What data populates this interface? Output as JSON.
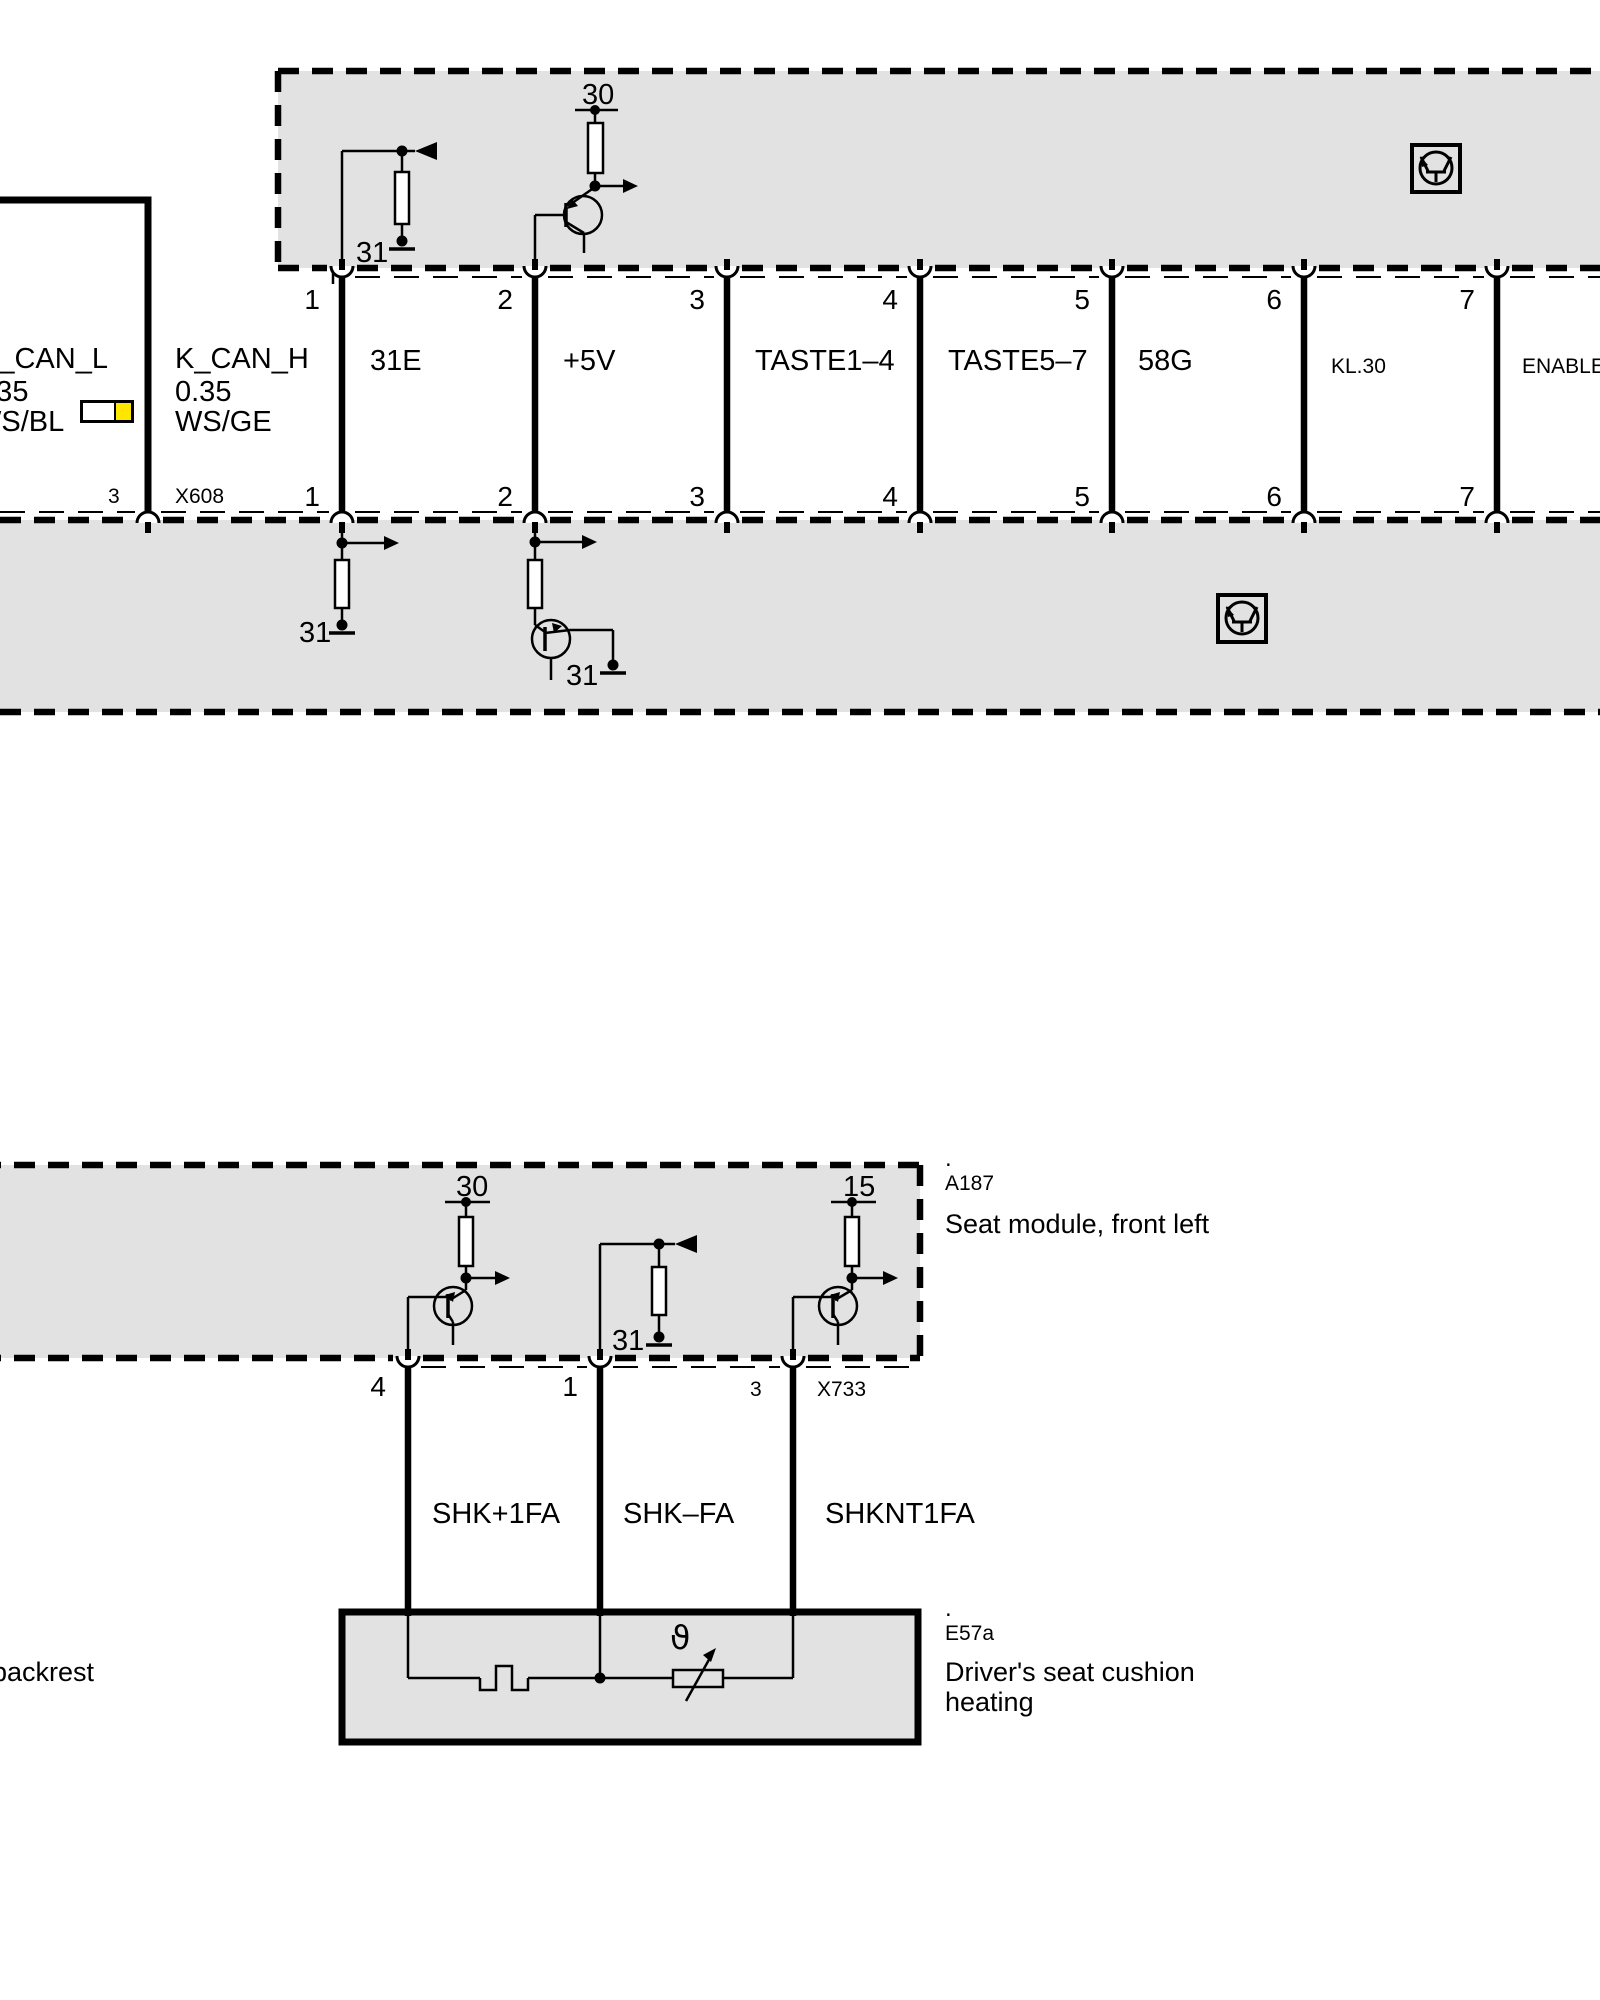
{
  "left_harness": {
    "can_l": {
      "name": "K_CAN_L",
      "gauge": "0.35",
      "color": "WS/BL"
    },
    "can_h": {
      "name": "K_CAN_H",
      "gauge": "0.35",
      "color": "WS/GE"
    },
    "pin": "3",
    "connector": "X608"
  },
  "top_module": {
    "supply_label": "30",
    "ground_label": "31",
    "pins_top": [
      "1",
      "2",
      "3",
      "4",
      "5",
      "6",
      "7"
    ],
    "pins_bottom": [
      "1",
      "2",
      "3",
      "4",
      "5",
      "6",
      "7"
    ],
    "wire_labels": [
      "31E",
      "+5V",
      "TASTE1–4",
      "TASTE5–7",
      "58G",
      "KL.30",
      "ENABLE"
    ]
  },
  "lower_band": {
    "ground_label_1": "31",
    "ground_label_2": "31"
  },
  "seat_module": {
    "dot": ".",
    "code": "A187",
    "name": "Seat module, front left",
    "supply_30": "30",
    "supply_15": "15",
    "ground_label": "31",
    "pins": [
      "4",
      "1",
      "3"
    ],
    "connector": "X733",
    "wire_labels": [
      "SHK+1FA",
      "SHK–FA",
      "SHKNT1FA"
    ]
  },
  "heater": {
    "dot": ".",
    "code": "E57a",
    "name": "Driver's seat cushion heating",
    "temp_symbol": "ϑ",
    "left_text": "backrest"
  },
  "colors": {
    "module_fill": "#e2e2e2",
    "swatch_yellow": "#ffe600"
  }
}
